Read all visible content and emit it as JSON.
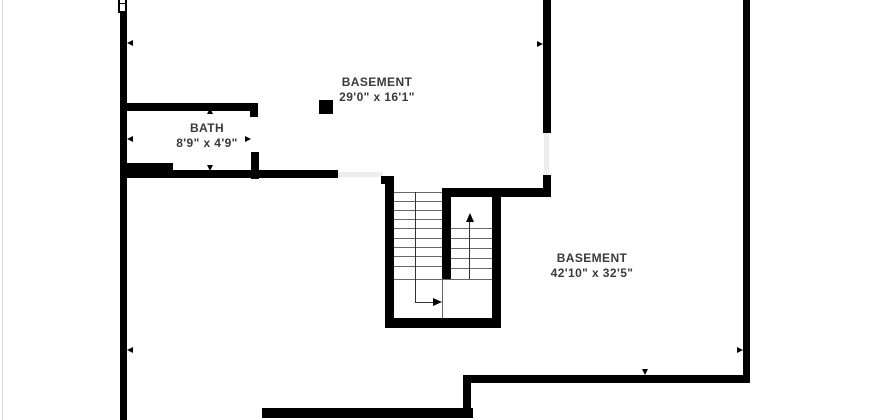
{
  "colors": {
    "wall": "#000000",
    "text": "#3a3a3a",
    "tread": "#666666",
    "walkline": "#333333",
    "background": "#ffffff",
    "threshold": "#ededed"
  },
  "rooms": [
    {
      "name": "BASEMENT",
      "dims": "29'0\" x 16'1\""
    },
    {
      "name": "BATH",
      "dims": "8'9\" x 4'9\""
    },
    {
      "name": "BASEMENT",
      "dims": "42'10\" x 32'5\""
    }
  ],
  "icons": {
    "window-icon": "hatched-rect",
    "column-marker-icon": "filled-square",
    "stair-up-arrow-icon": "triangle-up",
    "stair-down-arrow-icon": "triangle-right",
    "dimension-arrow-icon": "small-triangle"
  }
}
